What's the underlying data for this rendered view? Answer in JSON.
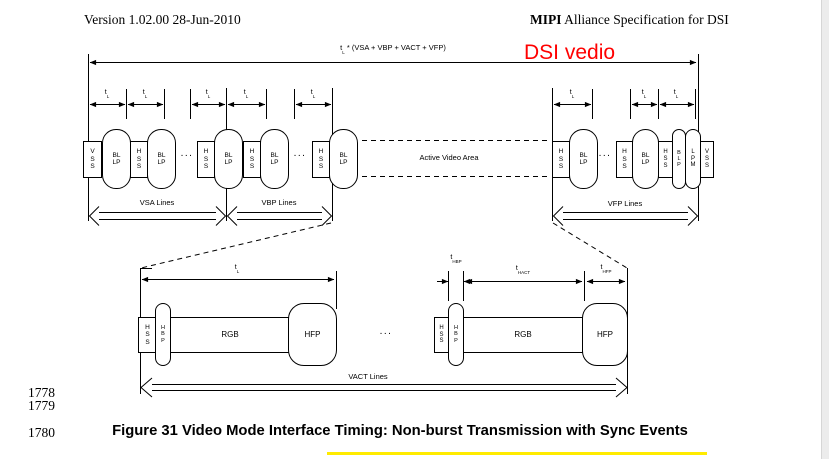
{
  "header": {
    "version": "Version 1.02.00 28-Jun-2010",
    "spec_brand": "MIPI",
    "spec_rest": " Alliance Specification for DSI"
  },
  "annotation": {
    "text": "DSI vedio",
    "color": "#ff0000"
  },
  "figure": {
    "frame_formula": {
      "base": "t",
      "sub": "L",
      "rest": " * (VSA + VBP + VACT + VFP)"
    },
    "tl": {
      "base": "t",
      "sub": "L"
    },
    "thbp": {
      "base": "t",
      "sub": "HBP"
    },
    "thact": {
      "base": "t",
      "sub": "HACT"
    },
    "thfp": {
      "base": "t",
      "sub": "HFP"
    },
    "active_video_label": "Active Video Area",
    "regions": {
      "vsa": "VSA Lines",
      "vbp": "VBP Lines",
      "vfp": "VFP Lines",
      "vact": "VACT Lines"
    },
    "dots": "...",
    "upper_row": [
      "V\nS\nS",
      "BL\nLP",
      "H\nS\nS",
      "BL\nLP",
      "...",
      "H\nS\nS",
      "BL\nLP",
      "H\nS\nS",
      "BL\nLP",
      "...",
      "H\nS\nS",
      "BL\nLP",
      "H\nS\nS",
      "BL\nLP",
      "...",
      "H\nS\nS",
      "BL\nLP",
      "H\nS\nS",
      "B\nL\nP",
      "L\nP\nM",
      "V\nS\nS"
    ],
    "lower_row": [
      "H\nS\nS",
      "H\nB\nP",
      "RGB",
      "HFP",
      "...",
      "H\nS\nS",
      "H\nB\nP",
      "RGB",
      "HFP"
    ]
  },
  "caption": "Figure 31 Video Mode Interface Timing: Non-burst Transmission with Sync Events",
  "line_numbers": [
    "1778",
    "1779",
    "1780"
  ],
  "colors": {
    "annotation_red": "#ff0000",
    "highlight_yellow": "#ffeb00",
    "page_edge_gray": "#ececec",
    "line_black": "#000000"
  }
}
